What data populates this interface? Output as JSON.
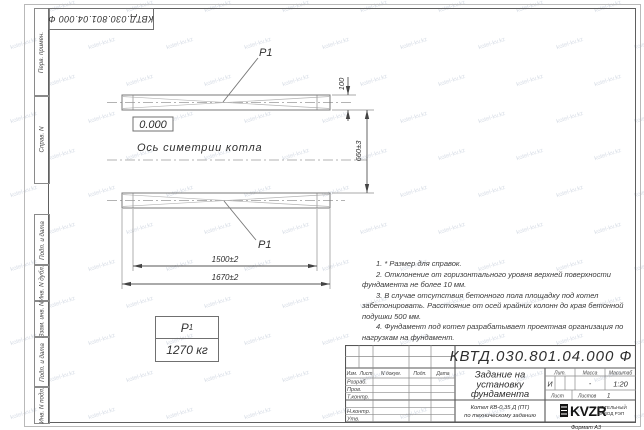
{
  "watermark": {
    "text": "kotel-kv.kz"
  },
  "stamp_top": {
    "code": "КВТД.030.801.04.000 Ф"
  },
  "frame_labels": {
    "perv": "Перв. примен.",
    "sprav": "Справ. N",
    "podp1": "Подп. и дата",
    "inv_dubl": "Инв. N дубл.",
    "vzam": "Взам. инв. N",
    "podp2": "Подп. и дата",
    "inv_podl": "Инв. N подл."
  },
  "drawing": {
    "p1_top": "P1",
    "p1_bottom": "P1",
    "elevation": "0.000",
    "axis_label": "Ось симетрии котла",
    "dim_100": "100",
    "dim_660": "660±3",
    "dim_1500": "1500±2",
    "dim_1670": "1670±2",
    "mass_label": "P",
    "mass_sub": "1",
    "mass_value": "1270 кг"
  },
  "notes": [
    "1. * Размер для справок.",
    "2. Отклонение от горизонтального уровня верхней поверхности фундамента не более 10 мм.",
    "3. В случае отсутствия бетонного пола площадку под котел забетонировать. Расстояние от осей крайних колонн до края бетонной подушки 500 мм.",
    "4. Фундамент под котел разрабатывает проектная организация по нагрузкам на фундамент."
  ],
  "title_block": {
    "doc_number": "КВТД.030.801.04.000 Ф",
    "header_cols": [
      "Изм.",
      "Лист",
      "N докум.",
      "Подп.",
      "Дата"
    ],
    "rows": [
      "Разраб.",
      "Пров.",
      "Т.контр.",
      "",
      "Н.контр.",
      "Утв."
    ],
    "title_lines": [
      "Задание на",
      "установку",
      "фундамента"
    ],
    "subtitle_lines": [
      "Котел КВ-0,35 Д (ПТ)",
      "по техническому заданию"
    ],
    "lit_label": "Лит.",
    "lit_value": "И",
    "massa_label": "Масса",
    "massa_value": "-",
    "masshtab_label": "Масштаб",
    "masshtab_value": "1:20",
    "list_label": "Лист",
    "listov_label": "Листов",
    "listov_value": "1",
    "logo_text": "KVZR",
    "org_line1": "КОТЕЛЬНЫЙ",
    "org_line2": "ЗАВОД РЭП",
    "format": "Формат А3"
  }
}
